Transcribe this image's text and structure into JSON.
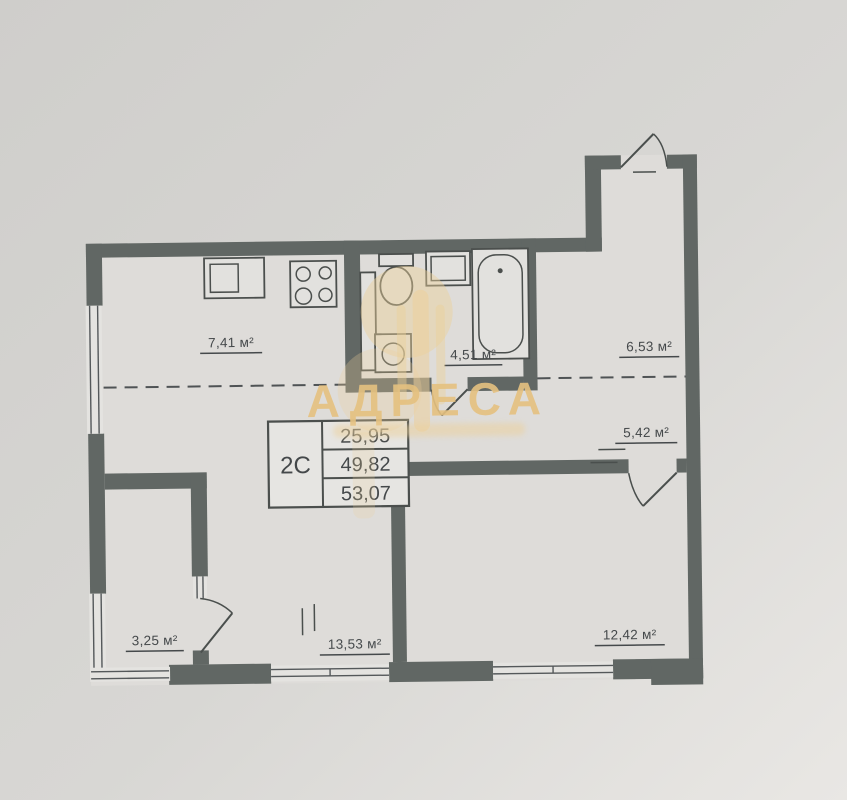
{
  "photo": {
    "background": "#d6d5d2"
  },
  "watermark": {
    "brand": "АДРЕСА",
    "color": "#e6c589"
  },
  "plan": {
    "unit_table": {
      "type_label": "2С",
      "values": [
        "25,95",
        "49,82",
        "53,07"
      ]
    },
    "rooms": [
      {
        "name": "kitchen-zone",
        "area_label": "7,41 м²"
      },
      {
        "name": "bathroom",
        "area_label": "4,51 м²"
      },
      {
        "name": "entrance-hall",
        "area_label": "6,53 м²"
      },
      {
        "name": "corridor",
        "area_label": "5,42 м²"
      },
      {
        "name": "balcony",
        "area_label": "3,25 м²"
      },
      {
        "name": "living-zone",
        "area_label": "13,53 м²"
      },
      {
        "name": "bedroom",
        "area_label": "12,42 м²"
      }
    ],
    "fixtures": [
      "kitchen-sink",
      "stove",
      "ventilation-shaft",
      "toilet",
      "washbasin",
      "bathtub",
      "washing-machine"
    ],
    "colors": {
      "wall": "#616764",
      "line": "#4b4f4d",
      "interior": "#dedcd9",
      "watermark_gold": "#e6c589"
    }
  }
}
